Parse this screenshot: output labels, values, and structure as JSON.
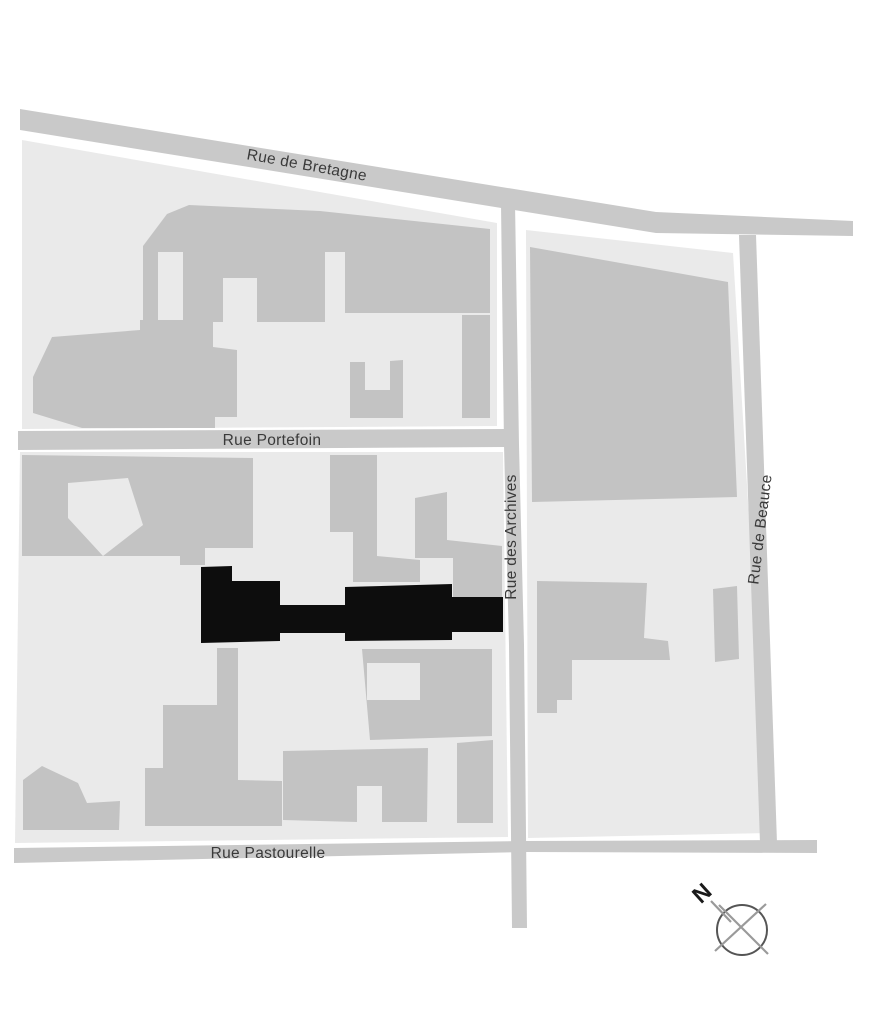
{
  "map": {
    "streets": [
      {
        "name": "Rue de Bretagne"
      },
      {
        "name": "Rue Portefoin"
      },
      {
        "name": "Rue des Archives"
      },
      {
        "name": "Rue de Beauce"
      },
      {
        "name": "Rue Pastourelle"
      }
    ],
    "compass": {
      "north_label": "N"
    },
    "colors": {
      "background": "#ffffff",
      "street": "#c9c9c9",
      "block": "#eaeaea",
      "building": "#c3c3c3",
      "highlight_building": "#0d0d0d",
      "label_text": "#3a3a3a",
      "compass_ring": "#555555",
      "compass_lines": "#9a9a9a",
      "compass_letter": "#1a1a1a"
    }
  }
}
